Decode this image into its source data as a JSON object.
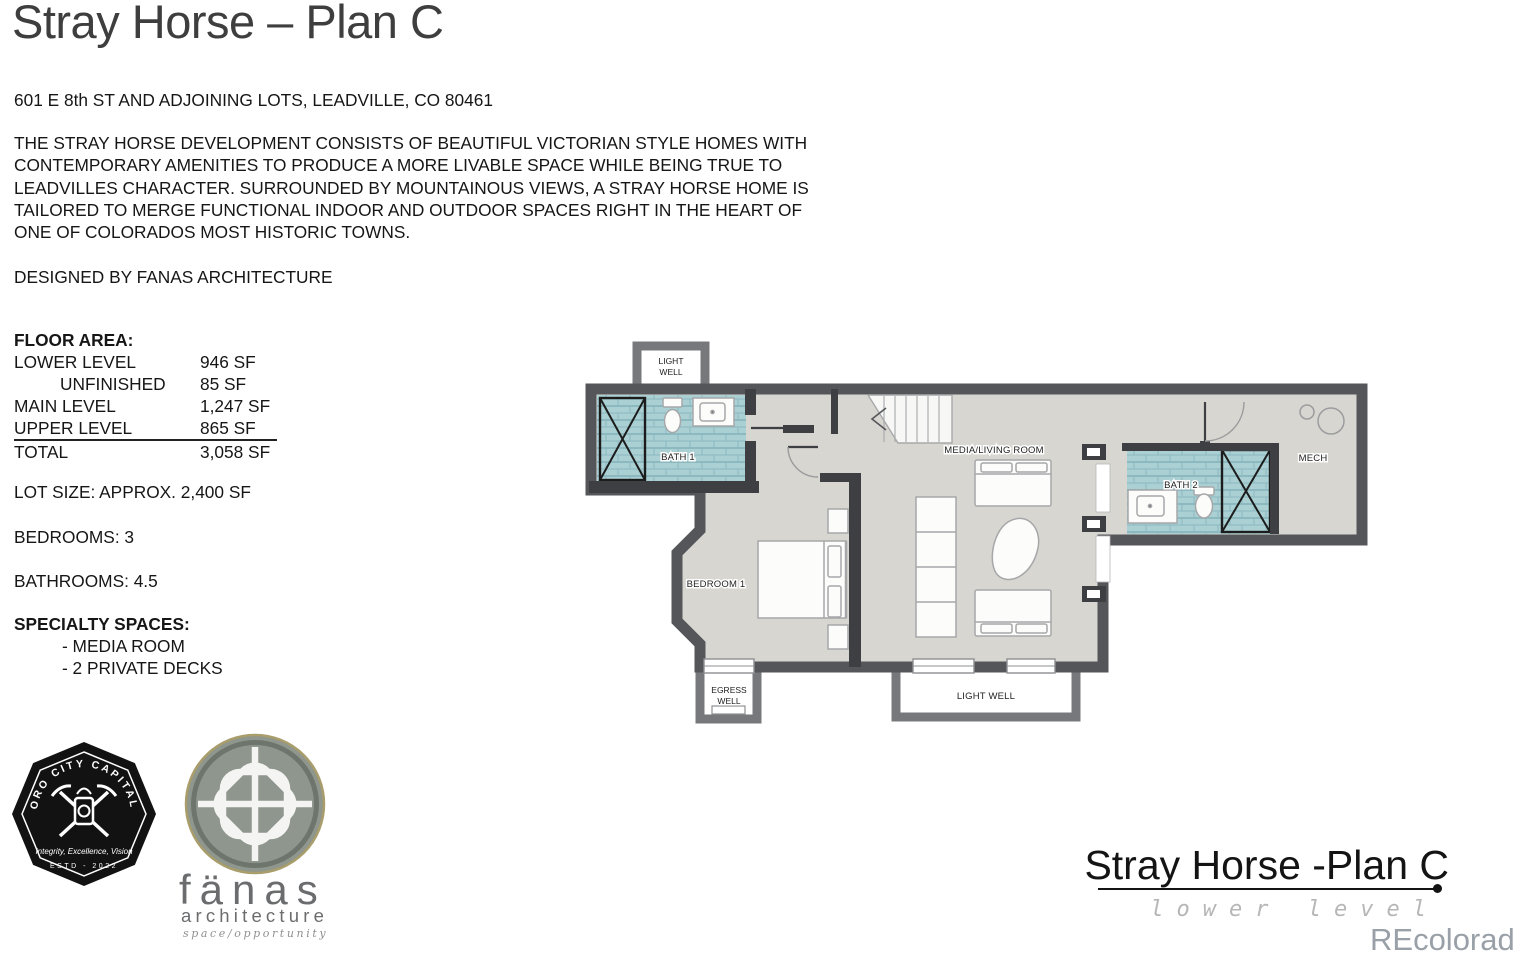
{
  "header": {
    "title": "Stray Horse – Plan C",
    "address": "601 E 8th ST AND ADJOINING LOTS, LEADVILLE, CO 80461"
  },
  "intro": {
    "description": "THE STRAY HORSE DEVELOPMENT CONSISTS OF BEAUTIFUL VICTORIAN STYLE HOMES WITH CONTEMPORARY AMENITIES TO PRODUCE A MORE LIVABLE SPACE WHILE BEING TRUE TO LEADVILLES CHARACTER. SURROUNDED BY MOUNTAINOUS VIEWS, A STRAY HORSE HOME IS TAILORED TO MERGE FUNCTIONAL INDOOR AND OUTDOOR SPACES RIGHT IN THE HEART OF ONE OF COLORADOS MOST HISTORIC TOWNS.",
    "designed_by": "DESIGNED BY FANAS ARCHITECTURE"
  },
  "floor_area": {
    "heading": "FLOOR AREA:",
    "rows": [
      {
        "label": "LOWER LEVEL",
        "value": "946 SF"
      },
      {
        "label": "UNFINISHED",
        "value": "85 SF"
      },
      {
        "label": "MAIN LEVEL",
        "value": "1,247 SF"
      },
      {
        "label": "UPPER LEVEL",
        "value": "865 SF"
      },
      {
        "label": "TOTAL",
        "value": "3,058 SF"
      }
    ]
  },
  "facts": {
    "lot_size": "LOT SIZE: APPROX. 2,400 SF",
    "bedrooms": "BEDROOMS: 3",
    "bathrooms": "BATHROOMS: 4.5"
  },
  "specialty": {
    "heading": "SPECIALTY SPACES:",
    "items": [
      "- MEDIA ROOM",
      "- 2 PRIVATE DECKS"
    ]
  },
  "logos": {
    "oro_city": {
      "arc_text": "ORO CITY CAPITAL",
      "tagline": "Integrity, Excellence, Vision",
      "established": "ESTD - 2022"
    },
    "fanas": {
      "name": "fänas",
      "subtitle": "architecture",
      "tagline": "space/opportunity"
    }
  },
  "plan": {
    "rooms": {
      "light_well_top": [
        "LIGHT",
        "WELL"
      ],
      "bath1": "BATH 1",
      "bedroom1": "BEDROOM 1",
      "media_living": "MEDIA/LIVING ROOM",
      "bath2": "BATH 2",
      "mech": "MECH",
      "egress_well": [
        "EGRESS",
        "WELL"
      ],
      "light_well_bottom": "LIGHT WELL"
    },
    "colors": {
      "wall": "#55565a",
      "well_wall": "#77787b",
      "floor": "#d8d6d1",
      "tile": "#abd0d4",
      "tile_line": "#8bb9bf"
    }
  },
  "footer": {
    "plan_title": "Stray Horse -Plan C",
    "level_label": "lower level",
    "watermark": "REcolorado"
  }
}
